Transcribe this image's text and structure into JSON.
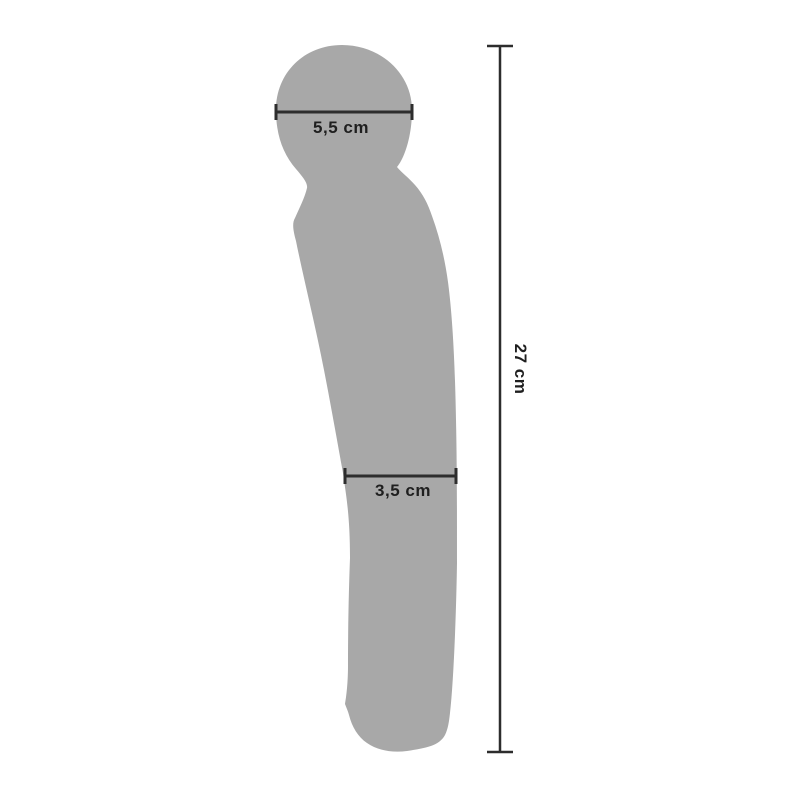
{
  "page": {
    "background_color": "#ffffff"
  },
  "diagram": {
    "kind": "product-dimension-diagram",
    "silhouette": {
      "name": "wand-massager-silhouette",
      "fill_color": "#a8a8a8"
    },
    "dimension_line_color": "#2d2d2d",
    "text_color": "#1f1f1f",
    "measurements": {
      "head_width": "5,5 cm",
      "shaft_width": "3,5 cm",
      "total_length": "27 cm"
    }
  }
}
